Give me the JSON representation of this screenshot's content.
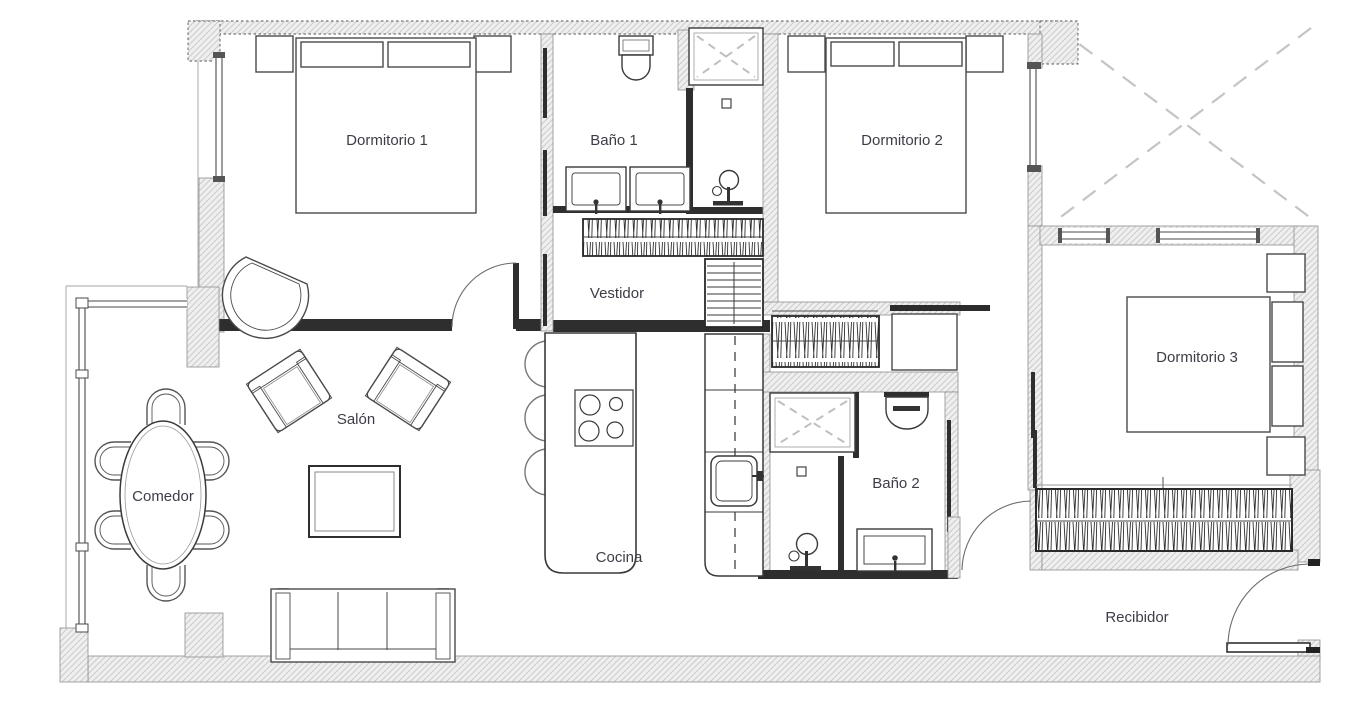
{
  "document": {
    "type": "floor-plan",
    "language": "es"
  },
  "rooms": [
    {
      "id": "dormitorio-1",
      "label": "Dormitorio 1"
    },
    {
      "id": "bano-1",
      "label": "Baño 1"
    },
    {
      "id": "vestidor",
      "label": "Vestidor"
    },
    {
      "id": "dormitorio-2",
      "label": "Dormitorio 2"
    },
    {
      "id": "dormitorio-3",
      "label": "Dormitorio 3"
    },
    {
      "id": "salon",
      "label": "Salón"
    },
    {
      "id": "comedor",
      "label": "Comedor"
    },
    {
      "id": "cocina",
      "label": "Cocina"
    },
    {
      "id": "bano-2",
      "label": "Baño 2"
    },
    {
      "id": "recibidor",
      "label": "Recibidor"
    }
  ],
  "colors": {
    "wall_fill": "#efefef",
    "wall_hatch_line": "#cccccc",
    "line": "#2e2e2e",
    "label_text": "#3d3d48",
    "dashed_gray": "#c0c0c0"
  },
  "furniture_icons": [
    "double-bed",
    "nightstand",
    "pillow",
    "wardrobe-hanging",
    "shelf-unit",
    "toilet",
    "sink",
    "shower-head",
    "shower-tray",
    "dining-table",
    "dining-chair",
    "armchair",
    "corner-chair",
    "coffee-table",
    "sofa",
    "kitchen-island",
    "stove",
    "bar-stool",
    "counter-sink",
    "door-swing",
    "terrace-cross"
  ]
}
